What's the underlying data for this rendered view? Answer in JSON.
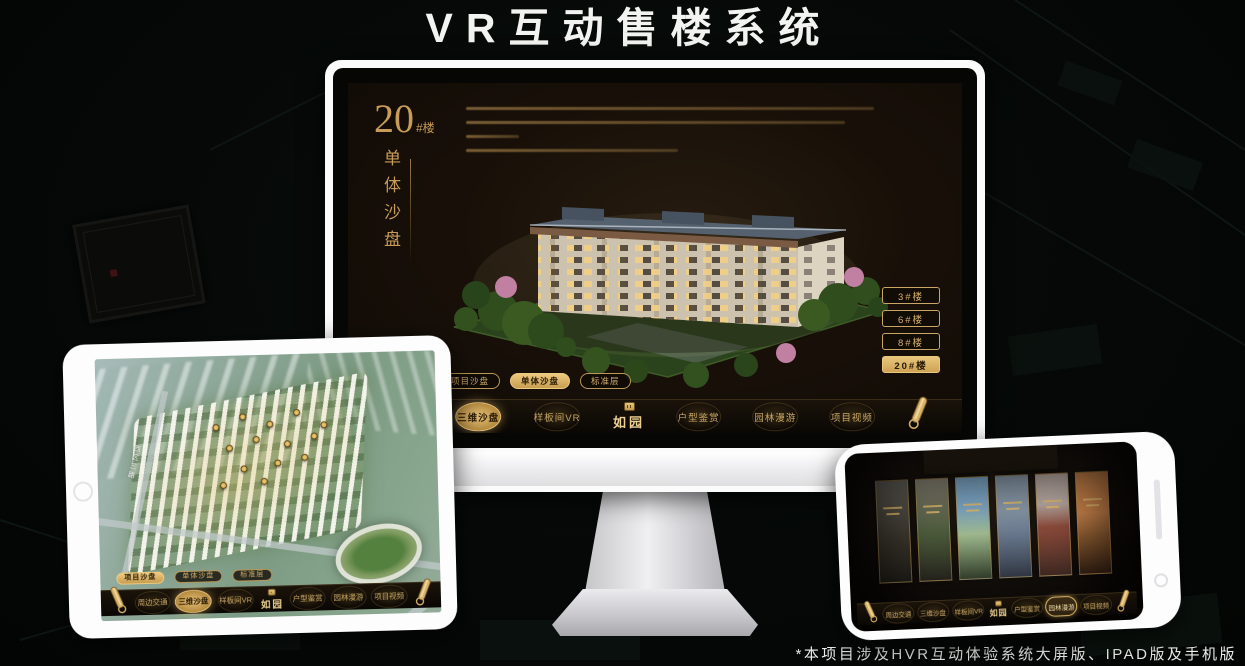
{
  "page": {
    "title": "VR互动售楼系统",
    "footnote": "*本项目涉及HVR互动体验系统大屏版、IPAD版及手机版"
  },
  "brand": {
    "logo": "如园"
  },
  "colors": {
    "gold": "#C9A35F",
    "gold_bright": "#E6C178",
    "screen_bg": "#181008",
    "headline_white": "#F3F3F1"
  },
  "icons": {
    "scroll": "rolled-gold-scroll",
    "seal": "gold-square-seal",
    "home_button": "circle",
    "speaker_slot": "pill"
  },
  "desktop": {
    "unit": {
      "number": "20",
      "suffix": "#楼",
      "subtitle": "单体沙盘"
    },
    "floor_buttons": [
      {
        "label": "3#楼",
        "active": false
      },
      {
        "label": "6#楼",
        "active": false
      },
      {
        "label": "8#楼",
        "active": false
      },
      {
        "label": "20#楼",
        "active": true
      }
    ],
    "mode_tabs": [
      {
        "label": "项目沙盘",
        "active": false
      },
      {
        "label": "单体沙盘",
        "active": true
      },
      {
        "label": "标准层",
        "active": false
      }
    ],
    "nav_items": [
      {
        "label": "周边交通",
        "active": false
      },
      {
        "label": "三维沙盘",
        "active": true
      },
      {
        "label": "样板间VR",
        "active": false
      },
      {
        "label": "户型鉴赏",
        "active": false
      },
      {
        "label": "园林漫游",
        "active": false
      },
      {
        "label": "项目视频",
        "active": false
      }
    ]
  },
  "tablet": {
    "road_label": "西区三路",
    "mode_tabs": [
      {
        "label": "项目沙盘",
        "active": true
      },
      {
        "label": "单体沙盘",
        "active": false
      },
      {
        "label": "标准层",
        "active": false
      }
    ],
    "nav_items": [
      {
        "label": "周边交通",
        "active": false
      },
      {
        "label": "三维沙盘",
        "active": true
      },
      {
        "label": "样板间VR",
        "active": false
      },
      {
        "label": "户型鉴赏",
        "active": false
      },
      {
        "label": "园林漫游",
        "active": false
      },
      {
        "label": "项目视频",
        "active": false
      }
    ]
  },
  "phone": {
    "nav_items": [
      {
        "label": "周边交通",
        "active": false
      },
      {
        "label": "三维沙盘",
        "active": false
      },
      {
        "label": "样板间VR",
        "active": false
      },
      {
        "label": "户型鉴赏",
        "active": false
      },
      {
        "label": "园林漫游",
        "active": true
      },
      {
        "label": "项目视频",
        "active": false
      }
    ]
  }
}
